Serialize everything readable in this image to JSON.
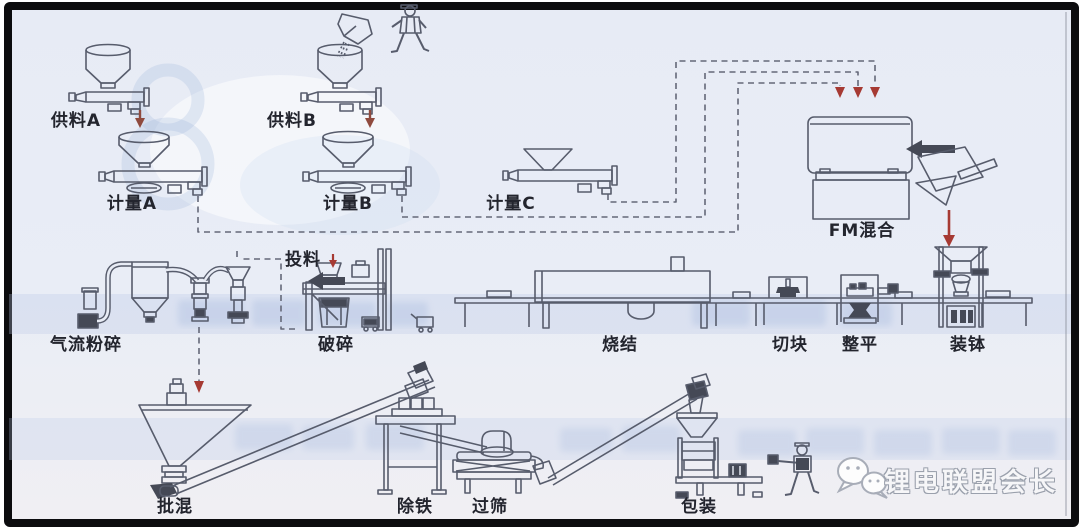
{
  "labels": {
    "feed_a": "供料A",
    "feed_b": "供料B",
    "meter_a": "计量A",
    "meter_b": "计量B",
    "meter_c": "计量C",
    "fm_mix": "FM混合",
    "jet_mill": "气流粉碎",
    "feeding": "投料",
    "crush": "破碎",
    "sinter": "烧结",
    "cut": "切块",
    "level": "整平",
    "sagger_load": "装钵",
    "batch_mix": "批混",
    "iron_removal": "除铁",
    "sieve": "过筛",
    "pack": "包装"
  },
  "watermark": {
    "icon": "wechat-icon",
    "text": "锂电联盟会长"
  },
  "colors": {
    "background": "#e9edf6",
    "frame": "#0c0c0e",
    "line_art": "#575c6c",
    "dark_fill": "#454956",
    "dashed_line": "#646878",
    "arrow_red": "#a63a33",
    "feed_arrow_brown": "#8f4a3e",
    "label_text": "#23252e",
    "watermark_fill": "#f6f6f8",
    "watermark_stroke": "#9aa0ac",
    "ghost_blue": "#93abd8"
  }
}
